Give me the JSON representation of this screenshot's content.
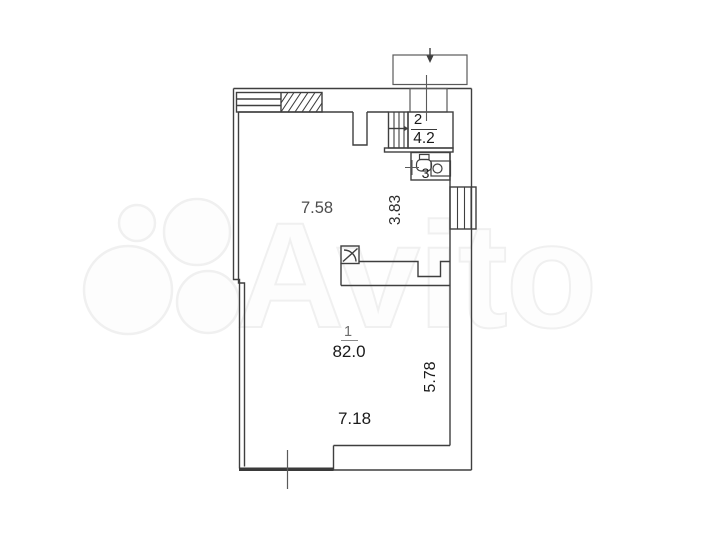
{
  "watermark": {
    "brand": "Avito"
  },
  "plan": {
    "room1": {
      "number": "1",
      "area": "82.0"
    },
    "room2": {
      "number": "2",
      "area": "4.2"
    },
    "room3": {
      "number": "3"
    },
    "dims": {
      "width_upper": "7.58",
      "width_upper_right": "3.83",
      "height_right": "5.78",
      "width_bottom": "7.18"
    },
    "colors": {
      "wall_line": "#3f3f3f",
      "thick_wall": "#3a3a3a",
      "label_dark": "#1a1a1a",
      "label_gray": "#4d4d4d",
      "watermark_outline": "#f0f0f0"
    }
  }
}
